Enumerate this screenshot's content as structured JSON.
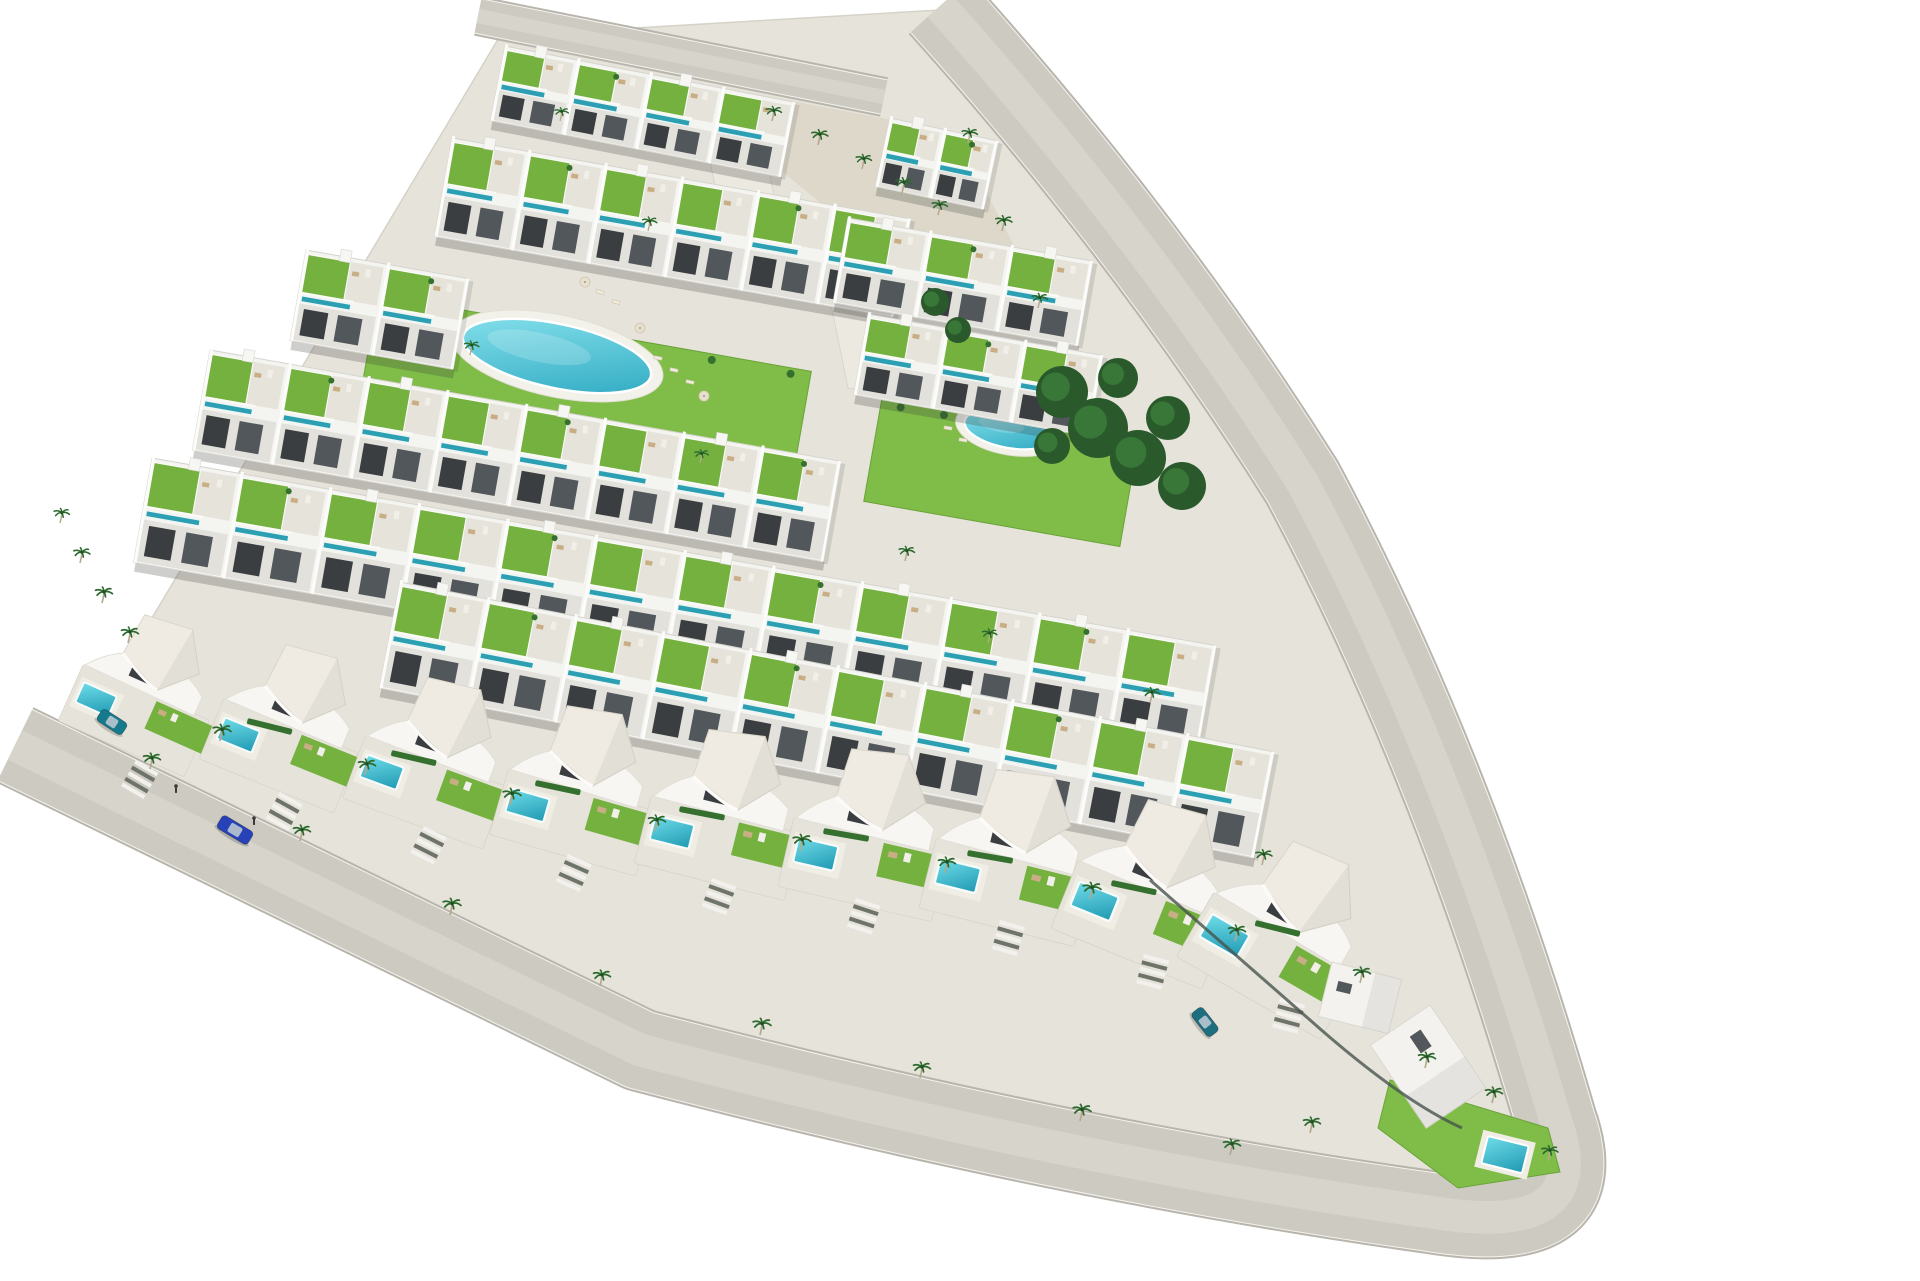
{
  "meta": {
    "title": "Aerial 3D render - triangular residential development",
    "description": "Bird's-eye architectural visualization of a triangular coastal residential complex: terraced rows of white townhouses with green roof-garden terraces and teal plunge pools, a large oval communal pool and a smaller round pool set in lawns, a front line of curved white villas with private pools, palm-lined perimeter roads, a blue car driving on the lower road, parked cars and pedestrians."
  },
  "palette": {
    "background": "#ffffff",
    "road": "#cdcac2",
    "road_edge": "#b8b5ac",
    "road_center": "#d7d4cb",
    "curb": "#f4f3ee",
    "paving": "#e6e3da",
    "paving_line": "#d5d2c8",
    "sand": "#ddd8ca",
    "walkway": "#ece9e0",
    "wall": "#f4f4f1",
    "wall_shade": "#e2e1dc",
    "wall_line": "#d6d4ce",
    "win": "#3a3e41",
    "win2": "#52575b",
    "grass": "#74b13f",
    "grass_light": "#7fbc48",
    "lap": "#2d9fb3",
    "pool_deep": "#1f98b2",
    "pool_light": "#6fdde9",
    "oval_deep": "#2aa7c0",
    "oval_light": "#8ce4ee",
    "palm": "#2d6a2e",
    "palm_trunk": "#b6a78c",
    "bush": "#35702f",
    "tree": "#2a5a2c",
    "tree_light": "#3b7a3a",
    "furniture": "#c9ae85",
    "roof": "#efebe2",
    "fence": "#49544d",
    "figure": "#3a3a38"
  },
  "scene": {
    "width": 1920,
    "height": 1280,
    "site": "500,36 940,10 1010,120 1240,420 1560,1125 1470,1205 1140,1172 620,1060 55,780",
    "sand": [
      "760,95 955,132 1038,292 898,266 768,160"
    ],
    "walkways": [
      "700,112 758,122 788,258 728,250",
      "830,300 880,308 900,395 848,388"
    ],
    "roads": [
      {
        "name": "top-road",
        "d": "M 478,16 L 884,97",
        "width": 34
      },
      {
        "name": "perimeter-road",
        "d": "M 940,6 Q 1150,240 1302,482 Q 1452,762 1556,1122 Q 1598,1240 1430,1212 Q 1060,1160 640,1050 L 15,745",
        "width": 78
      }
    ],
    "lawns": [
      {
        "x": 378,
        "y": 295,
        "w": 440,
        "h": 115,
        "rot": 10
      },
      {
        "x": 882,
        "y": 398,
        "w": 260,
        "h": 105,
        "rot": 10
      }
    ],
    "oval_pool": {
      "cx": 557,
      "cy": 356,
      "rx": 96,
      "ry": 32,
      "rot": 12
    },
    "round_pool": {
      "cx": 1010,
      "cy": 429,
      "rx": 46,
      "ry": 19,
      "rot": 10
    },
    "rows": [
      {
        "x": 505,
        "y": 46,
        "rot": 11,
        "len": 295,
        "depth": 76,
        "units": 4
      },
      {
        "x": 890,
        "y": 118,
        "rot": 12,
        "len": 110,
        "depth": 70,
        "units": 2
      },
      {
        "x": 452,
        "y": 138,
        "rot": 10,
        "len": 465,
        "depth": 100,
        "units": 6
      },
      {
        "x": 848,
        "y": 218,
        "rot": 10,
        "len": 248,
        "depth": 86,
        "units": 3
      },
      {
        "x": 306,
        "y": 250,
        "rot": 10,
        "len": 165,
        "depth": 92,
        "units": 2
      },
      {
        "x": 868,
        "y": 314,
        "rot": 10,
        "len": 238,
        "depth": 82,
        "units": 3
      },
      {
        "x": 210,
        "y": 350,
        "rot": 10,
        "len": 640,
        "depth": 102,
        "units": 8
      },
      {
        "x": 152,
        "y": 458,
        "rot": 10,
        "len": 1080,
        "depth": 106,
        "units": 12
      },
      {
        "x": 400,
        "y": 582,
        "rot": 11,
        "len": 890,
        "depth": 108,
        "units": 10
      }
    ],
    "trees": [
      [
        1062,
        392,
        26
      ],
      [
        1098,
        428,
        30
      ],
      [
        1138,
        458,
        28
      ],
      [
        1168,
        418,
        22
      ],
      [
        1118,
        378,
        20
      ],
      [
        1182,
        486,
        24
      ],
      [
        1052,
        446,
        18
      ],
      [
        935,
        302,
        14
      ],
      [
        958,
        330,
        13
      ]
    ],
    "villas": [
      [
        156,
        668,
        24,
        1.0
      ],
      [
        300,
        700,
        22,
        1.05
      ],
      [
        444,
        734,
        20,
        1.08
      ],
      [
        588,
        762,
        16,
        1.1
      ],
      [
        732,
        786,
        14,
        1.12
      ],
      [
        876,
        806,
        13,
        1.14
      ],
      [
        1020,
        828,
        14,
        1.16
      ],
      [
        1164,
        862,
        22,
        1.18
      ],
      [
        1300,
        906,
        30,
        1.2
      ]
    ],
    "tip_garden": {
      "poly": "1390,1080 1548,1128 1560,1172 1458,1188 1378,1128",
      "pool": {
        "x": 1488,
        "y": 1136,
        "w": 42,
        "h": 28,
        "rot": 14
      }
    },
    "buildings": [
      {
        "x": 1430,
        "y": 1005,
        "w": 100,
        "h": 72,
        "rot": 56
      },
      {
        "x": 1332,
        "y": 962,
        "w": 72,
        "h": 56,
        "rot": 14
      }
    ],
    "driveways": [
      [
        136,
        760,
        30
      ],
      [
        280,
        792,
        29
      ],
      [
        424,
        826,
        27
      ],
      [
        568,
        854,
        24
      ],
      [
        712,
        878,
        20
      ],
      [
        856,
        898,
        18
      ],
      [
        1000,
        920,
        16
      ],
      [
        1144,
        954,
        15
      ],
      [
        1280,
        998,
        15
      ]
    ],
    "hedges": [
      [
        248,
        718,
        46,
        14
      ],
      [
        392,
        750,
        46,
        13
      ],
      [
        536,
        780,
        46,
        12
      ],
      [
        680,
        806,
        46,
        11
      ],
      [
        824,
        828,
        46,
        10
      ],
      [
        968,
        850,
        46,
        10
      ],
      [
        1112,
        880,
        46,
        12
      ],
      [
        1256,
        920,
        46,
        14
      ]
    ],
    "fence": "M 1150,880 L 1310,1020 Q 1400,1100 1462,1128",
    "palms": [
      [
        220,
        738,
        1.05
      ],
      [
        365,
        772,
        1
      ],
      [
        510,
        802,
        1.05
      ],
      [
        655,
        828,
        1
      ],
      [
        800,
        848,
        1.05
      ],
      [
        945,
        870,
        1
      ],
      [
        1090,
        896,
        1.05
      ],
      [
        1235,
        938,
        1
      ],
      [
        1360,
        980,
        1
      ],
      [
        150,
        766,
        1
      ],
      [
        300,
        838,
        1
      ],
      [
        450,
        912,
        1.05
      ],
      [
        600,
        983,
        1
      ],
      [
        760,
        1032,
        1.05
      ],
      [
        920,
        1075,
        1
      ],
      [
        1080,
        1118,
        1.05
      ],
      [
        1230,
        1152,
        1
      ],
      [
        772,
        118,
        0.9
      ],
      [
        818,
        142,
        0.95
      ],
      [
        862,
        166,
        0.9
      ],
      [
        902,
        190,
        0.95
      ],
      [
        938,
        212,
        0.9
      ],
      [
        80,
        560,
        0.95
      ],
      [
        102,
        600,
        1
      ],
      [
        128,
        640,
        1
      ],
      [
        60,
        520,
        0.9
      ],
      [
        968,
        140,
        0.9
      ],
      [
        1002,
        228,
        0.95
      ],
      [
        1038,
        305,
        0.9
      ],
      [
        1310,
        1130,
        1
      ],
      [
        1425,
        1065,
        1
      ],
      [
        1492,
        1100,
        1
      ],
      [
        1548,
        1158,
        0.95
      ],
      [
        560,
        118,
        0.8
      ],
      [
        648,
        228,
        0.85
      ],
      [
        470,
        352,
        0.85
      ],
      [
        905,
        558,
        0.9
      ],
      [
        1150,
        700,
        0.95
      ],
      [
        988,
        640,
        0.85
      ],
      [
        1262,
        862,
        0.95
      ],
      [
        700,
        460,
        0.8
      ]
    ],
    "loungers": [
      [
        658,
        358,
        12
      ],
      [
        674,
        370,
        12
      ],
      [
        690,
        382,
        12
      ],
      [
        948,
        428,
        10
      ],
      [
        963,
        440,
        10
      ],
      [
        1048,
        412,
        10
      ],
      [
        1063,
        424,
        10
      ],
      [
        600,
        292,
        14
      ],
      [
        616,
        302,
        14
      ]
    ],
    "parasols": [
      [
        640,
        328
      ],
      [
        704,
        396
      ],
      [
        585,
        282
      ]
    ],
    "cars": [
      {
        "x": 235,
        "y": 830,
        "rot": 31,
        "color": "#2742b8",
        "len": 36,
        "wid": 15
      },
      {
        "x": 112,
        "y": 722,
        "rot": 33,
        "color": "#157a8c",
        "len": 30,
        "wid": 14
      },
      {
        "x": 1205,
        "y": 1022,
        "rot": 52,
        "color": "#1d6f80",
        "len": 30,
        "wid": 14
      }
    ],
    "people": [
      [
        176,
        790
      ],
      [
        254,
        822
      ]
    ]
  }
}
